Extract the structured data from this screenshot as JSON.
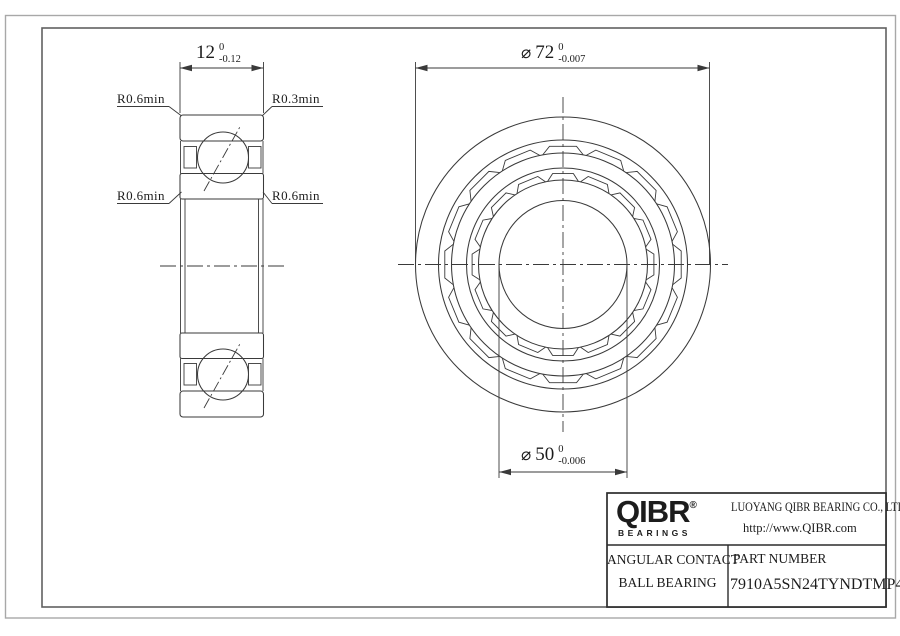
{
  "dimensions": {
    "width": {
      "value": "12",
      "upper": "0",
      "lower": "-0.12"
    },
    "outer_diameter": {
      "symbol": "⌀",
      "value": "72",
      "upper": "0",
      "lower": "-0.007"
    },
    "bore_diameter": {
      "symbol": "⌀",
      "value": "50",
      "upper": "0",
      "lower": "-0.006"
    }
  },
  "callouts": {
    "outer_left": "R0.6min",
    "outer_right": "R0.3min",
    "inner_left": "R0.6min",
    "inner_right": "R0.6min"
  },
  "title_block": {
    "brand": "QIBR",
    "brand_mark": "®",
    "brand_subtitle": "BEARINGS",
    "company": "LUOYANG QIBR BEARING CO., LTD",
    "website": "http://www.QIBR.com",
    "product_line1": "ANGULAR CONTACT",
    "product_line2": "BALL BEARING",
    "part_number_label": "PART NUMBER",
    "part_number": "7910A5SN24TYNDTMP4"
  },
  "front_view": {
    "cx": 563,
    "cy": 264.5,
    "ring_radii": [
      147.5,
      124.5,
      111.5,
      96.5,
      84.5,
      64
    ],
    "pocket_count": 16,
    "pocket_rows": [
      {
        "chord_r": 119,
        "chord_half_deg": 6.5,
        "slant_r": 111.5,
        "slant_half_deg": 10.5
      },
      {
        "chord_r": 91.5,
        "chord_half_deg": 6.5,
        "slant_r": 84.5,
        "slant_half_deg": 10.5
      }
    ]
  },
  "colors": {
    "line": "#3a3a3a",
    "frame": "#606060",
    "page_border": "#a8a8a8"
  }
}
